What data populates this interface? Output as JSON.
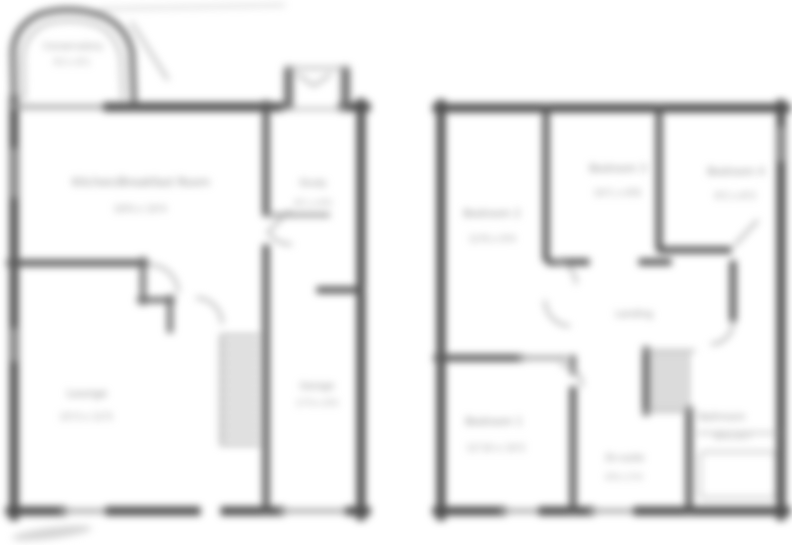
{
  "colors": {
    "background": "#ffffff",
    "wall": "#4d4d4d",
    "window": "#9f9f9f",
    "label": "#8a8a8a"
  },
  "plans": {
    "ground": {
      "rooms": {
        "conservatory": {
          "label": "Conservatory",
          "dims": "9'2 x 8'1"
        },
        "kitchen": {
          "label": "Kitchen/Breakfast Room",
          "dims": "18'6 x 10'4"
        },
        "lounge": {
          "label": "Lounge",
          "dims": "15'3 x 12'5"
        },
        "study": {
          "label": "Study",
          "dims": "8'1 x 6'9"
        },
        "garage": {
          "label": "Garage",
          "dims": "17'0 x 8'0"
        }
      }
    },
    "first": {
      "rooms": {
        "bedroom2": {
          "label": "Bedroom 2",
          "dims": "12'6 x 9'4"
        },
        "bedroom3": {
          "label": "Bedroom 3",
          "dims": "10'1 x 8'8"
        },
        "bedroom4": {
          "label": "Bedroom 4",
          "dims": "9'2 x 8'3"
        },
        "landing": {
          "label": "Landing"
        },
        "bedroom1": {
          "label": "Bedroom 1",
          "dims": "12'10 x 10'2"
        },
        "ensuite": {
          "label": "En-suite",
          "dims": "6'6 x 5'4"
        },
        "bathroom": {
          "label": "Bathroom",
          "dims": "8'4 x 6'7"
        }
      }
    }
  }
}
